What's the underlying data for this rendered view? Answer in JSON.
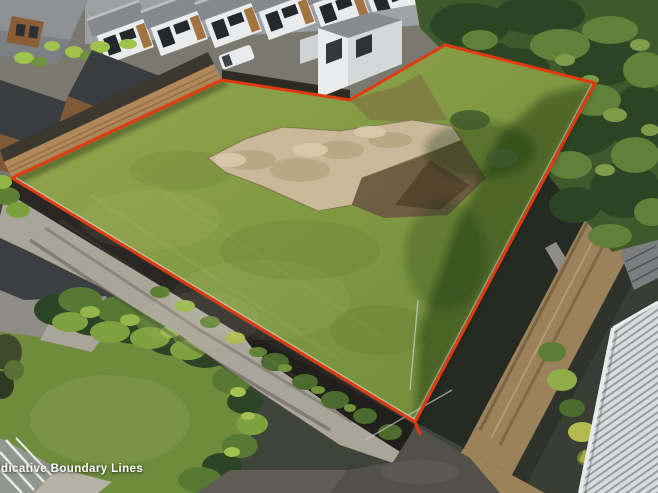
{
  "watermark": {
    "label": "Indicative Boundary Lines",
    "color": "#ffffff"
  },
  "boundary": {
    "color": "#e23a10",
    "stroke_width": 3,
    "points": "12,178 222,80 350,100 445,45 595,83 415,422"
  },
  "colors": {
    "yard_gray": "#7a786f",
    "lawn_light": "#94a74d",
    "lawn_dark": "#6e8a39",
    "lawn_neighbor": "#6f8c3d",
    "tree_dark": "#2c4424",
    "tree_mid": "#40592c",
    "tree_light": "#61813a",
    "bush_bright": "#9fc24c",
    "fence_dark": "#2e2a24",
    "timber_wall": "#b0885a",
    "house_timber": "#7d5a35",
    "roof_charcoal": "#3a3d3f",
    "roof_gray": "#9aa0a4",
    "roof_gray_dark": "#85898d",
    "wall_white": "#e9ebec",
    "concrete_light": "#aaa499",
    "concrete_mid": "#8f8c85",
    "pad_tan": "#c9b998",
    "pad_shadow": "#6d5b41",
    "dirt_drive": "#9b825a",
    "asphalt": "#52504b",
    "wall_black": "#2a2623",
    "metal_roof": "#d9dbdc",
    "metal_rib": "#9a9da0",
    "shadow_green": "#252a22"
  }
}
